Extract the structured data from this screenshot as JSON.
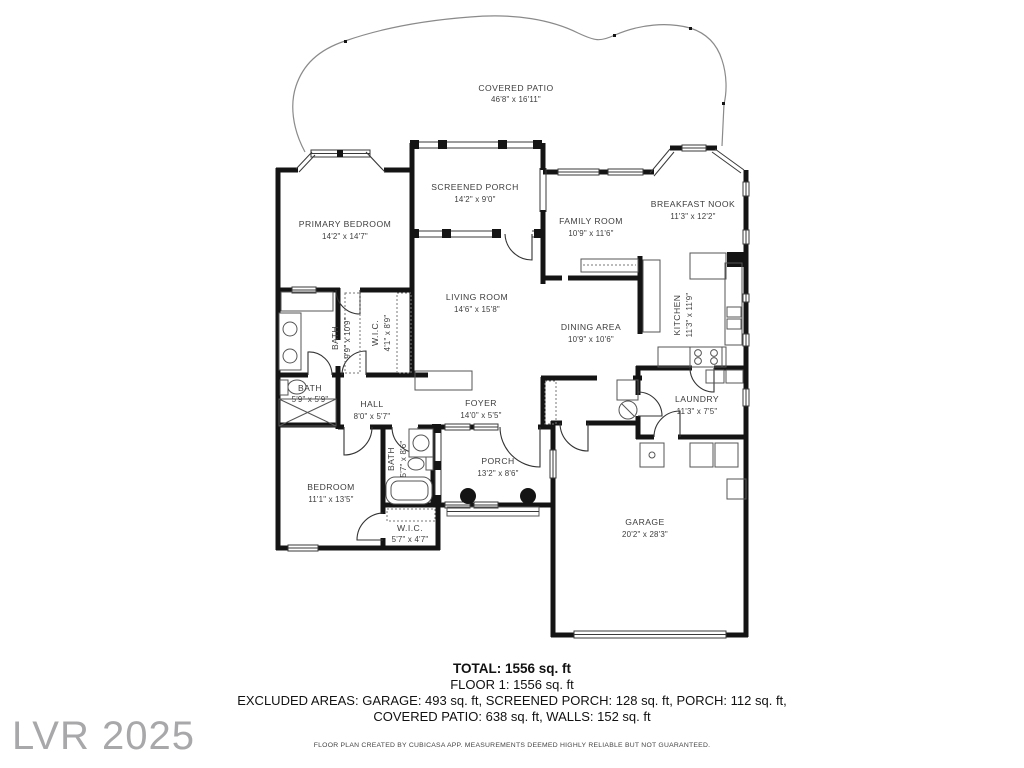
{
  "watermark": "LVR 2025",
  "colors": {
    "walls": "#141414",
    "labels": "#3d3d3d",
    "patio_outline": "#8a8a8a",
    "watermark": "#a8a8ab"
  },
  "rooms": [
    {
      "id": "covered-patio",
      "name": "COVERED PATIO",
      "dims": "46'8\" x 16'11\""
    },
    {
      "id": "primary-bedroom",
      "name": "PRIMARY BEDROOM",
      "dims": "14'2\" x 14'7\""
    },
    {
      "id": "screened-porch",
      "name": "SCREENED PORCH",
      "dims": "14'2\" x 9'0\""
    },
    {
      "id": "family-room",
      "name": "FAMILY ROOM",
      "dims": "10'9\" x 11'6\""
    },
    {
      "id": "breakfast-nook",
      "name": "BREAKFAST NOOK",
      "dims": "11'3\" x 12'2\""
    },
    {
      "id": "living-room",
      "name": "LIVING ROOM",
      "dims": "14'6\" x 15'8\""
    },
    {
      "id": "dining-area",
      "name": "DINING AREA",
      "dims": "10'9\" x 10'6\""
    },
    {
      "id": "kitchen",
      "name": "KITCHEN",
      "dims": "11'3\" x 11'9\""
    },
    {
      "id": "bath-primary",
      "name": "BATH",
      "dims": "9'9\" x 10'9\""
    },
    {
      "id": "wic-primary",
      "name": "W.I.C.",
      "dims": "4'1\" x 8'9\""
    },
    {
      "id": "bath-hall",
      "name": "BATH",
      "dims": "5'9\" x 5'9\""
    },
    {
      "id": "hall",
      "name": "HALL",
      "dims": "8'0\" x 5'7\""
    },
    {
      "id": "foyer",
      "name": "FOYER",
      "dims": "14'0\" x 5'5\""
    },
    {
      "id": "laundry",
      "name": "LAUNDRY",
      "dims": "11'3\" x 7'5\""
    },
    {
      "id": "bath-guest",
      "name": "BATH",
      "dims": "5'7\" x 8'6\""
    },
    {
      "id": "porch",
      "name": "PORCH",
      "dims": "13'2\" x 8'6\""
    },
    {
      "id": "bedroom",
      "name": "BEDROOM",
      "dims": "11'1\" x 13'5\""
    },
    {
      "id": "wic-bedroom",
      "name": "W.I.C.",
      "dims": "5'7\" x 4'7\""
    },
    {
      "id": "garage",
      "name": "GARAGE",
      "dims": "20'2\" x 28'3\""
    }
  ],
  "summary": {
    "total": "TOTAL: 1556 sq. ft",
    "floor": "FLOOR 1: 1556 sq. ft",
    "excluded_line1": "EXCLUDED AREAS: GARAGE: 493 sq. ft, SCREENED PORCH: 128 sq. ft, PORCH: 112 sq. ft,",
    "excluded_line2": "COVERED PATIO: 638 sq. ft, WALLS: 152 sq. ft",
    "disclaimer": "FLOOR PLAN CREATED BY CUBICASA APP. MEASUREMENTS DEEMED HIGHLY RELIABLE BUT NOT GUARANTEED."
  }
}
